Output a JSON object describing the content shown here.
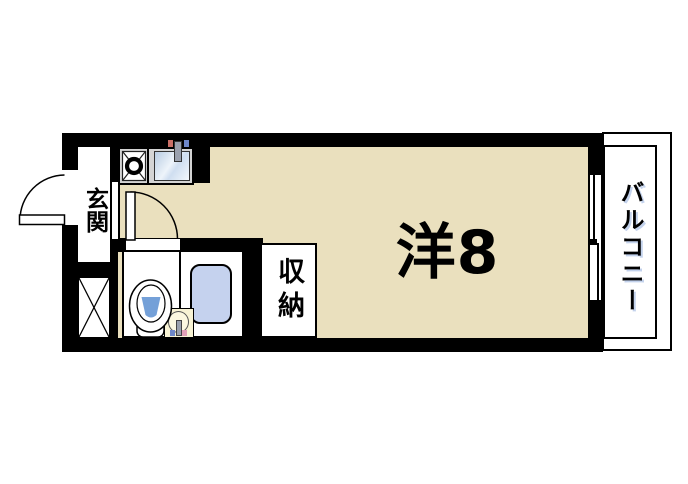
{
  "plan": {
    "labels": {
      "entrance": "玄関",
      "room": "洋8",
      "storage": "収納",
      "balcony": "バルコニー"
    },
    "colors": {
      "wall": "#000000",
      "room_floor": "#EAE0BE",
      "kitchen_counter": "#D4D4D4",
      "sink_blue": "#C9D9EA",
      "bathtub_blue": "#C5D2EE",
      "toilet_water_blue": "#74A0D8",
      "washbasin_cream": "#F8F3D4",
      "hot_tap_mark": "#C96F66",
      "cold_tap_mark": "#6E87C9",
      "background": "#FFFFFF"
    },
    "icons": {
      "entrance_door": "quarter-arc-swing-door",
      "room_door": "quarter-arc-swing-door",
      "gas_stove": "square-with-x-and-pot",
      "kitchen_sink": "blue-basin-with-faucet",
      "toilet": "bowl-ellipse-with-water",
      "washbasin": "round-bowl-with-taps",
      "bathtub": "rounded-blue-rect",
      "balcony_window": "double-line-sliding-window",
      "shaft": "crossed-box"
    }
  }
}
